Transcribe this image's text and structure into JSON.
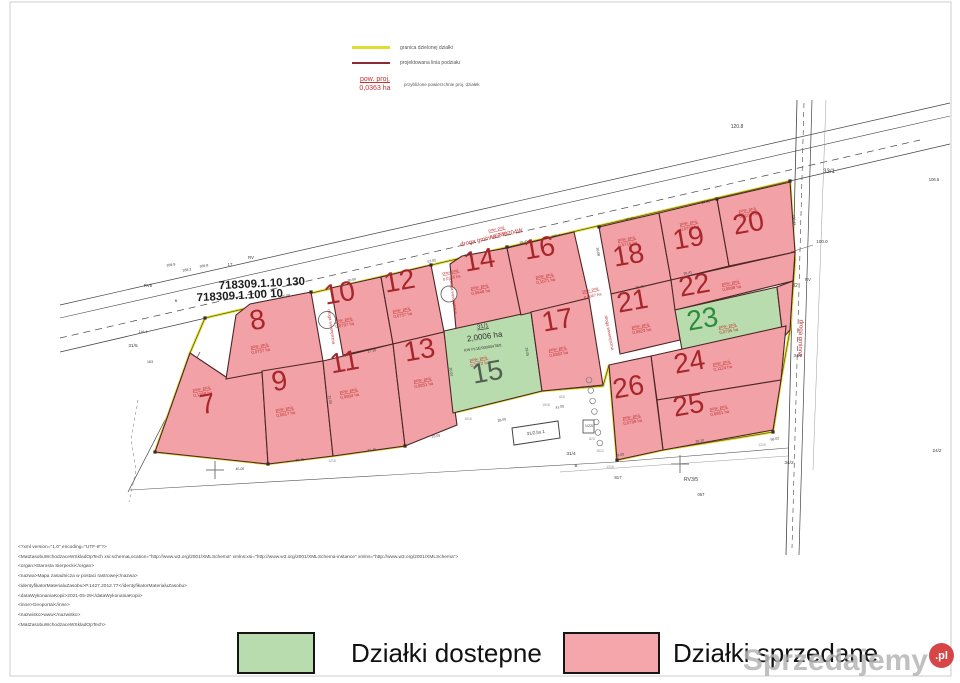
{
  "legend_top": {
    "items": [
      {
        "label": "granica dzielonej działki",
        "color": "#dede30"
      },
      {
        "label": "projektowana linia podziału",
        "color": "#8b2a35"
      }
    ],
    "area_symbol": {
      "title": "pow. proj.",
      "value": "0,0363 ha",
      "desc": "przybliżone powierzchnie proj. działek"
    }
  },
  "map": {
    "colors": {
      "sold": "#f2a1a6",
      "available": "#b8dcae",
      "boundary": "#dede30",
      "division": "#4d2626",
      "number_sold": "#a7262b",
      "number_available": "#2e8b3d",
      "label_red": "#c03333"
    },
    "area_label_title": "pow. proj.",
    "sheet_labels": [
      "718309.1.10 130",
      "718309.1.100 10"
    ],
    "boundary_outline": [
      [
        205,
        318
      ],
      [
        790,
        181
      ],
      [
        795,
        260
      ],
      [
        790,
        330
      ],
      [
        781,
        380
      ],
      [
        773,
        432
      ],
      [
        663,
        450
      ],
      [
        617,
        460
      ],
      [
        609,
        365
      ],
      [
        603,
        386
      ],
      [
        542,
        391
      ],
      [
        453,
        413
      ],
      [
        405,
        446
      ],
      [
        333,
        456
      ],
      [
        268,
        464
      ],
      [
        155,
        452
      ],
      [
        190,
        353
      ],
      [
        205,
        318
      ]
    ],
    "boundary_points": [
      [
        205,
        318
      ],
      [
        311,
        292
      ],
      [
        431,
        265
      ],
      [
        507,
        247
      ],
      [
        599,
        227
      ],
      [
        717,
        199
      ],
      [
        790,
        181
      ],
      [
        155,
        452
      ],
      [
        268,
        464
      ],
      [
        405,
        446
      ],
      [
        617,
        460
      ],
      [
        773,
        432
      ]
    ],
    "plots": [
      {
        "number": "7",
        "area": "0,1358 ha",
        "status": "sold",
        "poly": [
          [
            190,
            353
          ],
          [
            226,
            377
          ],
          [
            262,
            371
          ],
          [
            268,
            464
          ],
          [
            155,
            452
          ]
        ],
        "num": [
          209,
          413
        ],
        "lab": [
          202,
          390
        ]
      },
      {
        "number": "8",
        "area": "0,0757 ha",
        "status": "sold",
        "poly": [
          [
            236,
            315
          ],
          [
            250,
            304
          ],
          [
            311,
            292
          ],
          [
            323,
            361
          ],
          [
            226,
            379
          ]
        ],
        "num": [
          259,
          329
        ],
        "lab": [
          260,
          347
        ]
      },
      {
        "number": "9",
        "area": "0,0817 ha",
        "status": "sold",
        "poly": [
          [
            262,
            371
          ],
          [
            323,
            361
          ],
          [
            333,
            456
          ],
          [
            268,
            464
          ]
        ],
        "num": [
          281,
          390
        ],
        "lab": [
          285,
          410
        ]
      },
      {
        "number": "10",
        "area": "0,0797 ha",
        "status": "sold",
        "poly": [
          [
            331,
            288
          ],
          [
            381,
            277
          ],
          [
            393,
            344
          ],
          [
            343,
            355
          ]
        ],
        "num": [
          341,
          302
        ],
        "lab": [
          344,
          321
        ]
      },
      {
        "number": "11",
        "area": "0,0804 ha",
        "status": "sold",
        "poly": [
          [
            323,
            361
          ],
          [
            393,
            344
          ],
          [
            405,
            446
          ],
          [
            333,
            456
          ]
        ],
        "num": [
          346,
          371
        ],
        "lab": [
          349,
          392
        ]
      },
      {
        "number": "12",
        "area": "0,0757 ha",
        "status": "sold",
        "poly": [
          [
            381,
            277
          ],
          [
            431,
            265
          ],
          [
            444,
            332
          ],
          [
            393,
            344
          ]
        ],
        "num": [
          401,
          290
        ],
        "lab": [
          402,
          311
        ]
      },
      {
        "number": "13",
        "area": "0,0851 ha",
        "status": "sold",
        "poly": [
          [
            393,
            344
          ],
          [
            444,
            332
          ],
          [
            457,
            425
          ],
          [
            405,
            446
          ]
        ],
        "num": [
          421,
          359
        ],
        "lab": [
          423,
          381
        ]
      },
      {
        "number": "14",
        "area": "0,0840 ha",
        "status": "sold",
        "poly": [
          [
            450,
            264
          ],
          [
            462,
            256
          ],
          [
            507,
            248
          ],
          [
            521,
            315
          ],
          [
            456,
            329
          ]
        ],
        "num": [
          481,
          269
        ],
        "lab": [
          480,
          288
        ]
      },
      {
        "number": "15",
        "area": "0,1072 ha",
        "status": "available",
        "num_color": "#506052",
        "poly": [
          [
            444,
            331
          ],
          [
            531,
            312
          ],
          [
            542,
            391
          ],
          [
            453,
            413
          ]
        ],
        "num": [
          489,
          381
        ],
        "lab": [
          479,
          360
        ],
        "extra": {
          "parcel": "31/1",
          "parcel_area": "2,0006 ha",
          "kw": "KW PL1E/00000478/8"
        }
      },
      {
        "number": "16",
        "area": "0,1071 ha",
        "status": "sold",
        "poly": [
          [
            507,
            248
          ],
          [
            574,
            232
          ],
          [
            589,
            298
          ],
          [
            521,
            315
          ]
        ],
        "num": [
          541,
          257
        ],
        "lab": [
          545,
          277
        ]
      },
      {
        "number": "17",
        "area": "0,0862 ha",
        "status": "sold",
        "poly": [
          [
            531,
            312
          ],
          [
            589,
            298
          ],
          [
            603,
            385
          ],
          [
            542,
            391
          ]
        ],
        "num": [
          559,
          329
        ],
        "lab": [
          558,
          350
        ]
      },
      {
        "number": "18",
        "area": "0,0710 ha",
        "status": "sold",
        "poly": [
          [
            599,
            227
          ],
          [
            659,
            213
          ],
          [
            671,
            280
          ],
          [
            611,
            294
          ]
        ],
        "num": [
          630,
          264
        ],
        "lab": [
          627,
          240
        ]
      },
      {
        "number": "19",
        "area": "0,0793 ha",
        "status": "sold",
        "poly": [
          [
            659,
            213
          ],
          [
            717,
            199
          ],
          [
            729,
            266
          ],
          [
            671,
            280
          ]
        ],
        "num": [
          690,
          247
        ],
        "lab": [
          689,
          224
        ]
      },
      {
        "number": "20",
        "area": "0,1011 ha",
        "status": "sold",
        "poly": [
          [
            717,
            199
          ],
          [
            790,
            182
          ],
          [
            795,
            252
          ],
          [
            729,
            266
          ]
        ],
        "num": [
          750,
          232
        ],
        "lab": [
          748,
          211
        ]
      },
      {
        "number": "21",
        "area": "0,0823 ha",
        "status": "sold",
        "poly": [
          [
            611,
            294
          ],
          [
            671,
            280
          ],
          [
            680,
            340
          ],
          [
            620,
            354
          ]
        ],
        "num": [
          634,
          310
        ],
        "lab": [
          641,
          327
        ]
      },
      {
        "number": "22",
        "area": "0,0898 ha",
        "status": "sold",
        "poly": [
          [
            671,
            280
          ],
          [
            795,
            252
          ],
          [
            793,
            281
          ],
          [
            675,
            310
          ]
        ],
        "num": [
          696,
          294
        ],
        "lab": [
          731,
          284
        ]
      },
      {
        "number": "23",
        "area": "0,0795 ha",
        "status": "available",
        "poly": [
          [
            675,
            310
          ],
          [
            777,
            287
          ],
          [
            783,
            338
          ],
          [
            682,
            350
          ]
        ],
        "num": [
          704,
          328
        ],
        "lab": [
          728,
          327
        ]
      },
      {
        "number": "",
        "area": "",
        "status": "sold",
        "poly": [
          [
            777,
            287
          ],
          [
            793,
            281
          ],
          [
            790,
            330
          ],
          [
            783,
            338
          ]
        ],
        "num": null,
        "lab": null
      },
      {
        "number": "24",
        "area": "0,1124 ha",
        "status": "sold",
        "poly": [
          [
            651,
            356
          ],
          [
            786,
            326
          ],
          [
            781,
            380
          ],
          [
            657,
            400
          ]
        ],
        "num": [
          691,
          371
        ],
        "lab": [
          722,
          364
        ]
      },
      {
        "number": "25",
        "area": "0,0861 ha",
        "status": "sold",
        "poly": [
          [
            657,
            400
          ],
          [
            781,
            380
          ],
          [
            773,
            430
          ],
          [
            663,
            450
          ]
        ],
        "num": [
          690,
          414
        ],
        "lab": [
          719,
          409
        ]
      },
      {
        "number": "26",
        "area": "0,0799 ha",
        "status": "sold",
        "poly": [
          [
            609,
            365
          ],
          [
            651,
            356
          ],
          [
            663,
            450
          ],
          [
            617,
            460
          ]
        ],
        "num": [
          630,
          396
        ],
        "lab": [
          632,
          418
        ]
      }
    ],
    "annotations": [
      [
        "droga gminna 240204W",
        492,
        239,
        -13,
        6,
        "r"
      ],
      [
        "droga gminna",
        799,
        338,
        92,
        6,
        "r"
      ],
      [
        "droga wewnętrzna",
        330,
        327,
        82,
        4.3,
        "r"
      ],
      [
        "droga wewnętrzna",
        452,
        297,
        82,
        4.3,
        "r"
      ],
      [
        "droga wewnętrzna",
        608,
        333,
        79,
        4.3,
        "r"
      ],
      [
        "pow. proj.",
        451,
        273,
        -12,
        4,
        "r",
        1
      ],
      [
        "0,0325 ha",
        452,
        279,
        -12,
        4,
        "r"
      ],
      [
        "pow. proj.",
        591,
        291,
        -12,
        4,
        "r",
        1
      ],
      [
        "0,0667 ha",
        593,
        297,
        -12,
        4,
        "r"
      ],
      [
        "pow. proj.",
        497,
        230,
        -13,
        4,
        "r",
        1
      ],
      [
        "0,0627 ha",
        499,
        236,
        -13,
        4,
        "r"
      ],
      [
        "120.8",
        737,
        128,
        0,
        5,
        "d"
      ],
      [
        "33/1",
        829,
        173,
        0,
        6,
        "d"
      ],
      [
        "106.5",
        934,
        181,
        0,
        4.2,
        "d"
      ],
      [
        "100.0",
        822,
        243,
        0,
        4.5,
        "d"
      ],
      [
        "32",
        795,
        287,
        0,
        5,
        "d"
      ],
      [
        "RV",
        808,
        281,
        0,
        4.2,
        "d"
      ],
      [
        "34/2",
        798,
        357,
        0,
        4.6,
        "d"
      ],
      [
        "RVb",
        148,
        287,
        0,
        4.4,
        "d"
      ],
      [
        "RV",
        251,
        259,
        0,
        4.4,
        "d"
      ],
      [
        "17",
        230,
        266,
        0,
        4.4,
        "d"
      ],
      [
        "169.9",
        171,
        266,
        -8,
        3.6,
        "d"
      ],
      [
        "168.2",
        187,
        271,
        -8,
        3.6,
        "d"
      ],
      [
        "169.8",
        204,
        267,
        -8,
        3.6,
        "d"
      ],
      [
        "31/5",
        133,
        347,
        0,
        4.8,
        "d"
      ],
      [
        "B",
        176,
        302,
        0,
        4,
        "d"
      ],
      [
        "163",
        150,
        363,
        0,
        3.6,
        "d"
      ],
      [
        "116.4",
        143,
        333,
        0,
        3.6,
        "d"
      ],
      [
        "31/4",
        571,
        455,
        0,
        4.8,
        "d"
      ],
      [
        "B",
        576,
        467,
        0,
        4.4,
        "d"
      ],
      [
        "817",
        618,
        479,
        0,
        4.4,
        "d"
      ],
      [
        "RV3/5",
        691,
        481,
        0,
        5.2,
        "d"
      ],
      [
        "34/2",
        789,
        464,
        0,
        4.8,
        "d"
      ],
      [
        "057",
        701,
        496,
        0,
        4.2,
        "d"
      ],
      [
        "24/2",
        937,
        452,
        0,
        4.6,
        "d"
      ],
      [
        "31/2,bu.1",
        536,
        434,
        -8,
        4.4,
        "d"
      ],
      [
        "1/22i",
        589,
        427,
        0,
        3.8,
        "d"
      ],
      [
        "30.50",
        352,
        281,
        -13,
        3.5,
        "d"
      ],
      [
        "57.02",
        432,
        262,
        -13,
        3.5,
        "d"
      ],
      [
        "8.05",
        468,
        256,
        -13,
        3.5,
        "d"
      ],
      [
        "28.41",
        524,
        243,
        -13,
        3.5,
        "d"
      ],
      [
        "26.41",
        630,
        220,
        -13,
        3.5,
        "d"
      ],
      [
        "24.41",
        706,
        203,
        -13,
        3.5,
        "d"
      ],
      [
        "100.4",
        556,
        237,
        -13,
        3.5,
        "d"
      ],
      [
        "25.08",
        286,
        297,
        -13,
        3.5,
        "d"
      ],
      [
        "100.43",
        793,
        220,
        85,
        3.5,
        "d"
      ],
      [
        "30.08",
        597,
        252,
        80,
        3.5,
        "d"
      ],
      [
        "31.05",
        329,
        400,
        82,
        3.5,
        "d"
      ],
      [
        "30.02",
        450,
        372,
        82,
        3.5,
        "d"
      ],
      [
        "28.05",
        526,
        352,
        82,
        3.5,
        "d"
      ],
      [
        "45.05",
        240,
        470,
        -3,
        3.5,
        "d"
      ],
      [
        "39.45",
        300,
        461,
        -5,
        3.5,
        "d"
      ],
      [
        "31.45",
        372,
        451,
        -7,
        3.5,
        "d"
      ],
      [
        "25.05",
        436,
        437,
        -9,
        3.5,
        "d"
      ],
      [
        "28.05",
        502,
        421,
        -11,
        3.5,
        "d"
      ],
      [
        "41.05",
        560,
        408,
        -11,
        3.5,
        "d"
      ],
      [
        "39.10",
        700,
        442,
        -12,
        3.5,
        "d"
      ],
      [
        "29.00",
        620,
        456,
        -10,
        3.5,
        "d"
      ],
      [
        "58.02",
        775,
        440,
        -12,
        3.5,
        "d"
      ],
      [
        "26.41",
        688,
        274,
        -13,
        3.5,
        "d"
      ],
      [
        "25.41",
        640,
        288,
        -13,
        3.5,
        "d"
      ],
      [
        "17.10",
        372,
        352,
        -11,
        3.5,
        "d"
      ],
      [
        "1515",
        468,
        420,
        0,
        3.4,
        "g"
      ],
      [
        "1518",
        546,
        406,
        0,
        3.4,
        "g"
      ],
      [
        "1512",
        600,
        452,
        0,
        3.4,
        "g"
      ],
      [
        "1215",
        332,
        462,
        0,
        3.4,
        "g"
      ],
      [
        "1216",
        610,
        468,
        0,
        3.4,
        "g"
      ],
      [
        "818",
        562,
        398,
        0,
        3.4,
        "g"
      ],
      [
        "823",
        592,
        440,
        0,
        3.4,
        "g"
      ],
      [
        "1219",
        762,
        446,
        0,
        3.4,
        "g"
      ]
    ]
  },
  "xml_block": {
    "lines": [
      "<?xml version=\"1.0\" encoding=\"UTF-8\"?>",
      "<MatZasobuWchodzaceWSkladOpTech xsi:schemaLocation=\"http://www.w3.org/2001/XMLSchema\" xmlns:xsi=\"http://www.w3.org/2001/XMLSchema-instance\" xmlns=\"http://www.w3.org/2001/XMLSchema\">",
      "<organ>Starosta Sierpecki</organ>",
      "<nazwa>Mapa zasadnicza w postaci rastrowej</nazwa>",
      "<identyfikatorMaterialuZasobu>P.1427.2012.77</identyfikatorMaterialuZasobu>",
      "<dataWykonaniaKopii>2021-05-29</dataWykonaniaKopii>",
      "<inne>Geoportal</inne>",
      "<nazwisko>www</nazwisko>",
      "<MatZasobuWchodzaceWSkladOpTech>"
    ]
  },
  "legend_bottom": {
    "available": {
      "label": "Działki dostepne",
      "color": "#b8dcae"
    },
    "sold": {
      "label": "Działki sprzedane",
      "color": "#f4a6aa"
    }
  },
  "watermark": {
    "text": "Sprzedajemy",
    "suffix": ".pl"
  }
}
